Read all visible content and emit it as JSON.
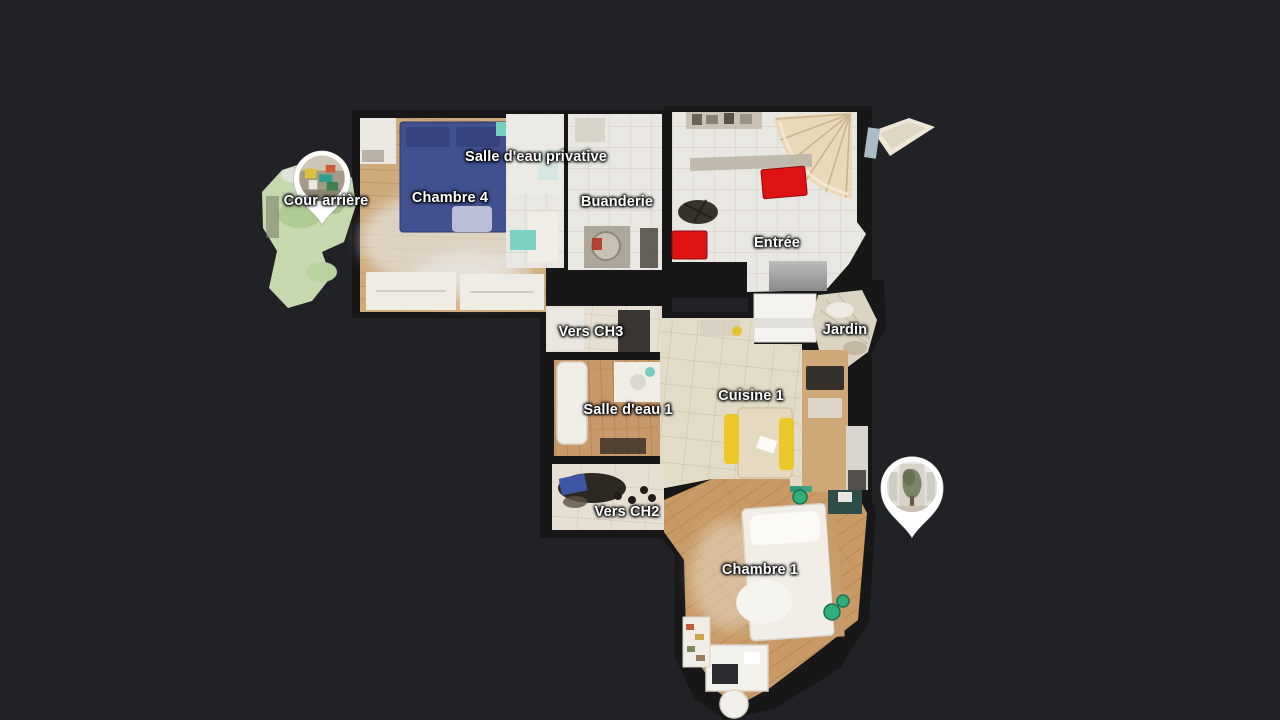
{
  "scene": {
    "view_mode": "floorplan",
    "background_color": "#212226"
  },
  "rooms": [
    {
      "id": "cour-arriere",
      "label": "Cour arrière",
      "x": 326,
      "y": 201
    },
    {
      "id": "chambre-4",
      "label": "Chambre 4",
      "x": 450,
      "y": 198
    },
    {
      "id": "salle-eau-privative",
      "label": "Salle d'eau privative",
      "x": 536,
      "y": 157
    },
    {
      "id": "buanderie",
      "label": "Buanderie",
      "x": 617,
      "y": 202
    },
    {
      "id": "entree",
      "label": "Entrée",
      "x": 777,
      "y": 243
    },
    {
      "id": "vers-ch3",
      "label": "Vers CH3",
      "x": 591,
      "y": 332
    },
    {
      "id": "jardin",
      "label": "Jardin",
      "x": 845,
      "y": 330
    },
    {
      "id": "salle-eau-1",
      "label": "Salle d'eau 1",
      "x": 628,
      "y": 410
    },
    {
      "id": "cuisine-1",
      "label": "Cuisine 1",
      "x": 751,
      "y": 396
    },
    {
      "id": "vers-ch2",
      "label": "Vers CH2",
      "x": 627,
      "y": 512
    },
    {
      "id": "chambre-1",
      "label": "Chambre 1",
      "x": 760,
      "y": 570
    }
  ],
  "markers": [
    {
      "id": "pano-marker-cour-arriere",
      "x": 322,
      "y": 182,
      "scale": 0.95
    },
    {
      "id": "pano-marker-jardin",
      "x": 912,
      "y": 491,
      "scale": 1.05
    }
  ],
  "palette": {
    "background": "#212226",
    "wall": "#171717",
    "tile_white": "#e9e7e2",
    "tile_beige": "#e2dbc8",
    "wood_light": "#cfab7c",
    "wood_warm": "#c9996a",
    "bed_blue": "#41508f",
    "chair_red": "#df1313",
    "chair_yellow": "#ecc728",
    "grass_green": "#c6d8ae",
    "accent_teal": "#74cfc0",
    "marker": "#ffffff"
  }
}
